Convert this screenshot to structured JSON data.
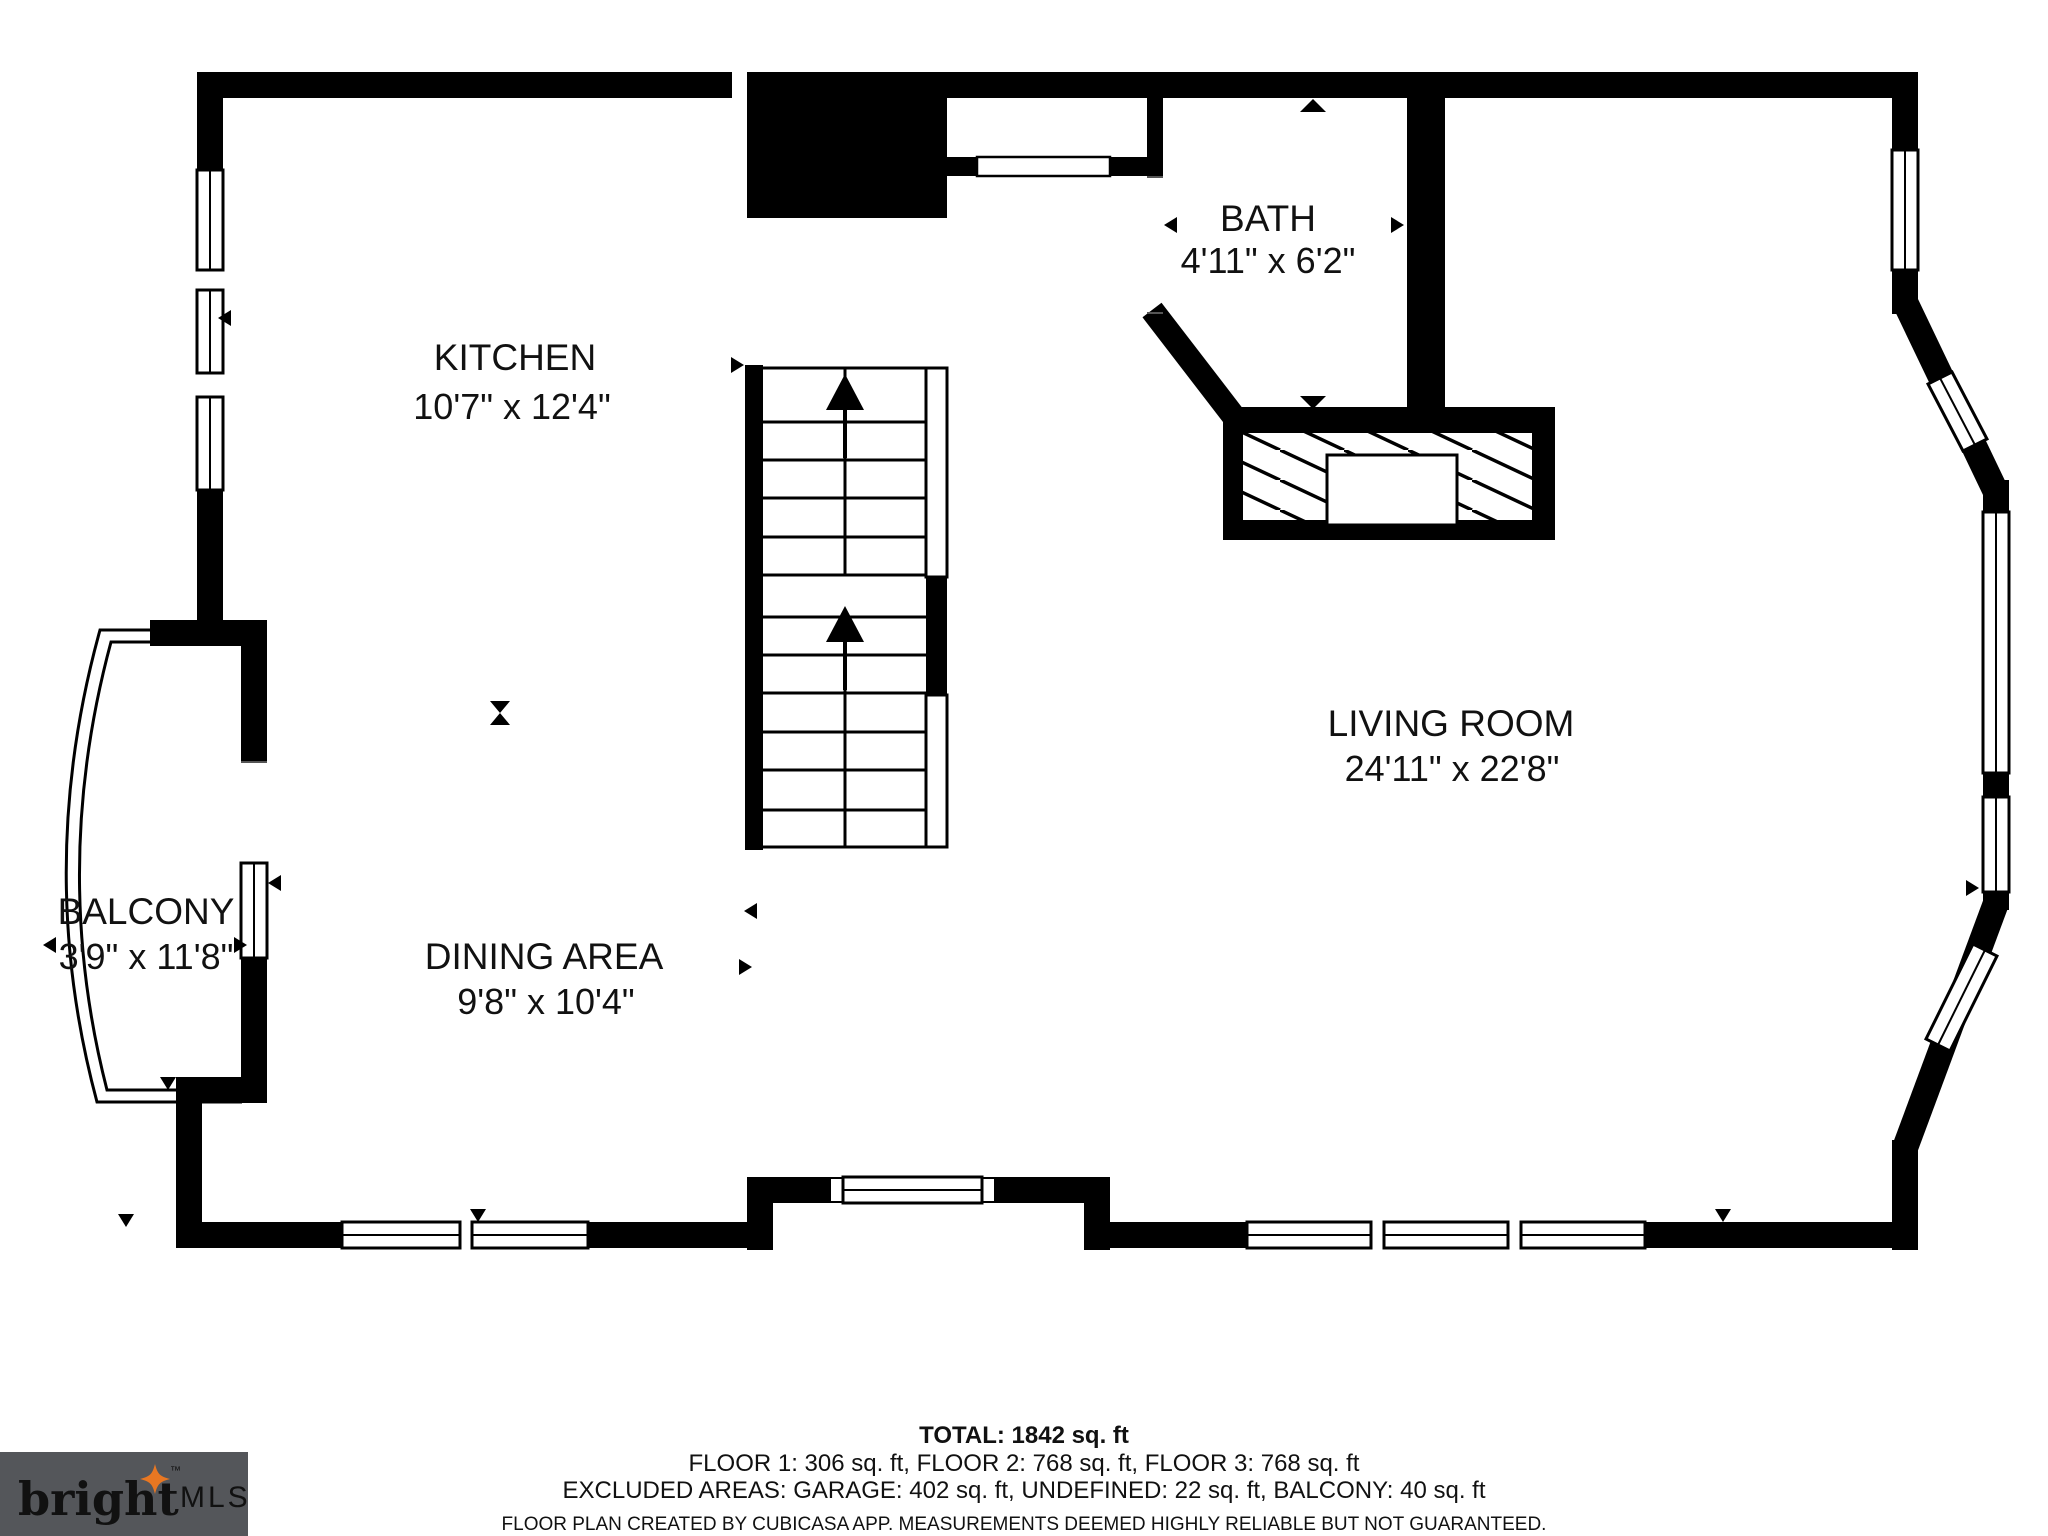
{
  "plan": {
    "rooms": [
      {
        "name": "KITCHEN",
        "dims": "10'7\" x 12'4\""
      },
      {
        "name": "BATH",
        "dims": "4'11\" x 6'2\""
      },
      {
        "name": "LIVING ROOM",
        "dims": "24'11\" x 22'8\""
      },
      {
        "name": "DINING AREA",
        "dims": "9'8\" x 10'4\""
      },
      {
        "name": "BALCONY",
        "dims": "3'9\" x 11'8\""
      }
    ]
  },
  "footer": {
    "total": "TOTAL: 1842 sq. ft",
    "floors": "FLOOR 1: 306 sq. ft, FLOOR 2: 768 sq. ft, FLOOR 3: 768 sq. ft",
    "excluded": "EXCLUDED AREAS: GARAGE: 402 sq. ft, UNDEFINED: 22 sq. ft, BALCONY: 40 sq. ft",
    "disclaimer": "FLOOR PLAN CREATED BY CUBICASA APP. MEASUREMENTS DEEMED HIGHLY RELIABLE BUT NOT GUARANTEED."
  },
  "logo": {
    "brand": "bright",
    "suffix": "MLS",
    "tm": "™"
  },
  "colors": {
    "wall": "#000000",
    "background": "#ffffff",
    "disclaimer_text": "#a8a8a8",
    "logo_bg": "#54565a",
    "logo_text": "#f4f4f2",
    "logo_suffix": "#b9babc",
    "logo_star": "#e87722"
  }
}
